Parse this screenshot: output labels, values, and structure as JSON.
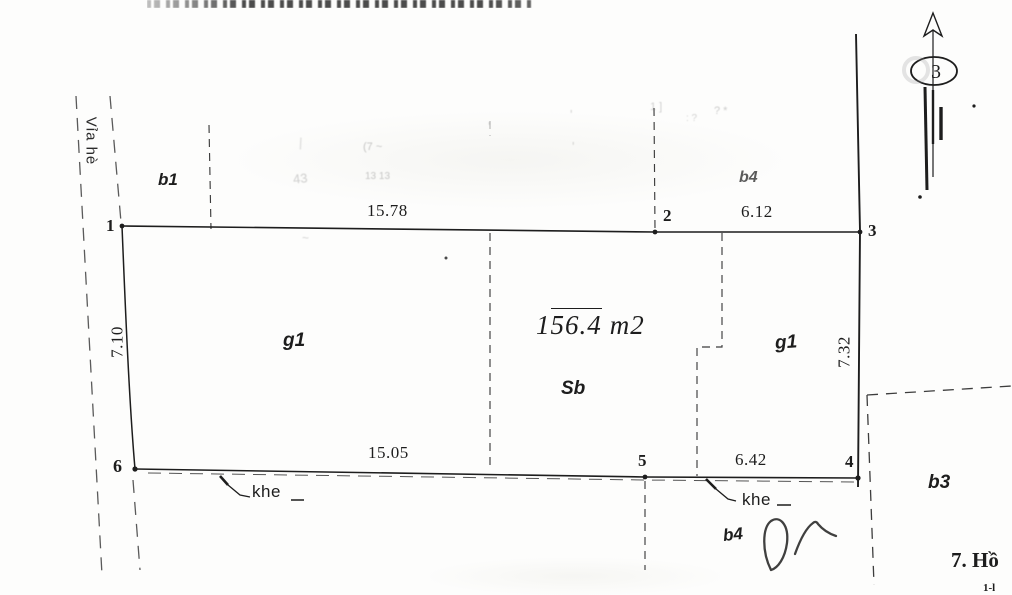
{
  "colors": {
    "ink": "#1d1d1d",
    "dash_gray": "#5a5a5a",
    "paper": "#fdfdfc"
  },
  "street": {
    "label": "Vỉa hè"
  },
  "north_arrow": {
    "number": "3"
  },
  "points": {
    "p1": "1",
    "p2": "2",
    "p3": "3",
    "p4": "4",
    "p5": "5",
    "p6": "6"
  },
  "dimensions": {
    "top_left": "15.78",
    "top_right": "6.12",
    "bottom_left": "15.05",
    "bottom_right": "6.42",
    "left_side": "7.10",
    "right_side": "7.32"
  },
  "area": {
    "prefix": "1",
    "overlined": "56.4",
    "unit": "m2"
  },
  "zones": {
    "b1": "b1",
    "b4_top": "b4",
    "g1_left": "g1",
    "g1_right": "g1",
    "sb": "Sb",
    "b3": "b3",
    "b4_bottom": "b4"
  },
  "gap_labels": {
    "first": "khe",
    "second": "khe"
  },
  "corner_text": {
    "line1": "7. Hồ",
    "line2": "1-l"
  },
  "smudges": [
    {
      "text": "|",
      "x": 299,
      "y": 136,
      "size": 13,
      "rot": 3,
      "o": 0.25
    },
    {
      "text": "43",
      "x": 293,
      "y": 172,
      "size": 13,
      "rot": -6,
      "o": 0.32
    },
    {
      "text": "(7 ~",
      "x": 363,
      "y": 142,
      "size": 11,
      "rot": 0,
      "o": 0.38
    },
    {
      "text": "13 13",
      "x": 365,
      "y": 172,
      "size": 10,
      "rot": 0,
      "o": 0.38
    },
    {
      "text": "'",
      "x": 488,
      "y": 120,
      "size": 13,
      "rot": 0,
      "o": 0.3
    },
    {
      "text": "'",
      "x": 570,
      "y": 108,
      "size": 13,
      "rot": 0,
      "o": 0.3
    },
    {
      "text": "'",
      "x": 572,
      "y": 140,
      "size": 13,
      "rot": 0,
      "o": 0.3
    },
    {
      "text": "1 ]",
      "x": 650,
      "y": 102,
      "size": 11,
      "rot": 0,
      "o": 0.32
    },
    {
      "text": ": ?",
      "x": 686,
      "y": 114,
      "size": 10,
      "rot": 0,
      "o": 0.3
    },
    {
      "text": "? *",
      "x": 714,
      "y": 106,
      "size": 11,
      "rot": 0,
      "o": 0.35
    },
    {
      "text": "~",
      "x": 302,
      "y": 232,
      "size": 12,
      "rot": 0,
      "o": 0.3
    }
  ]
}
